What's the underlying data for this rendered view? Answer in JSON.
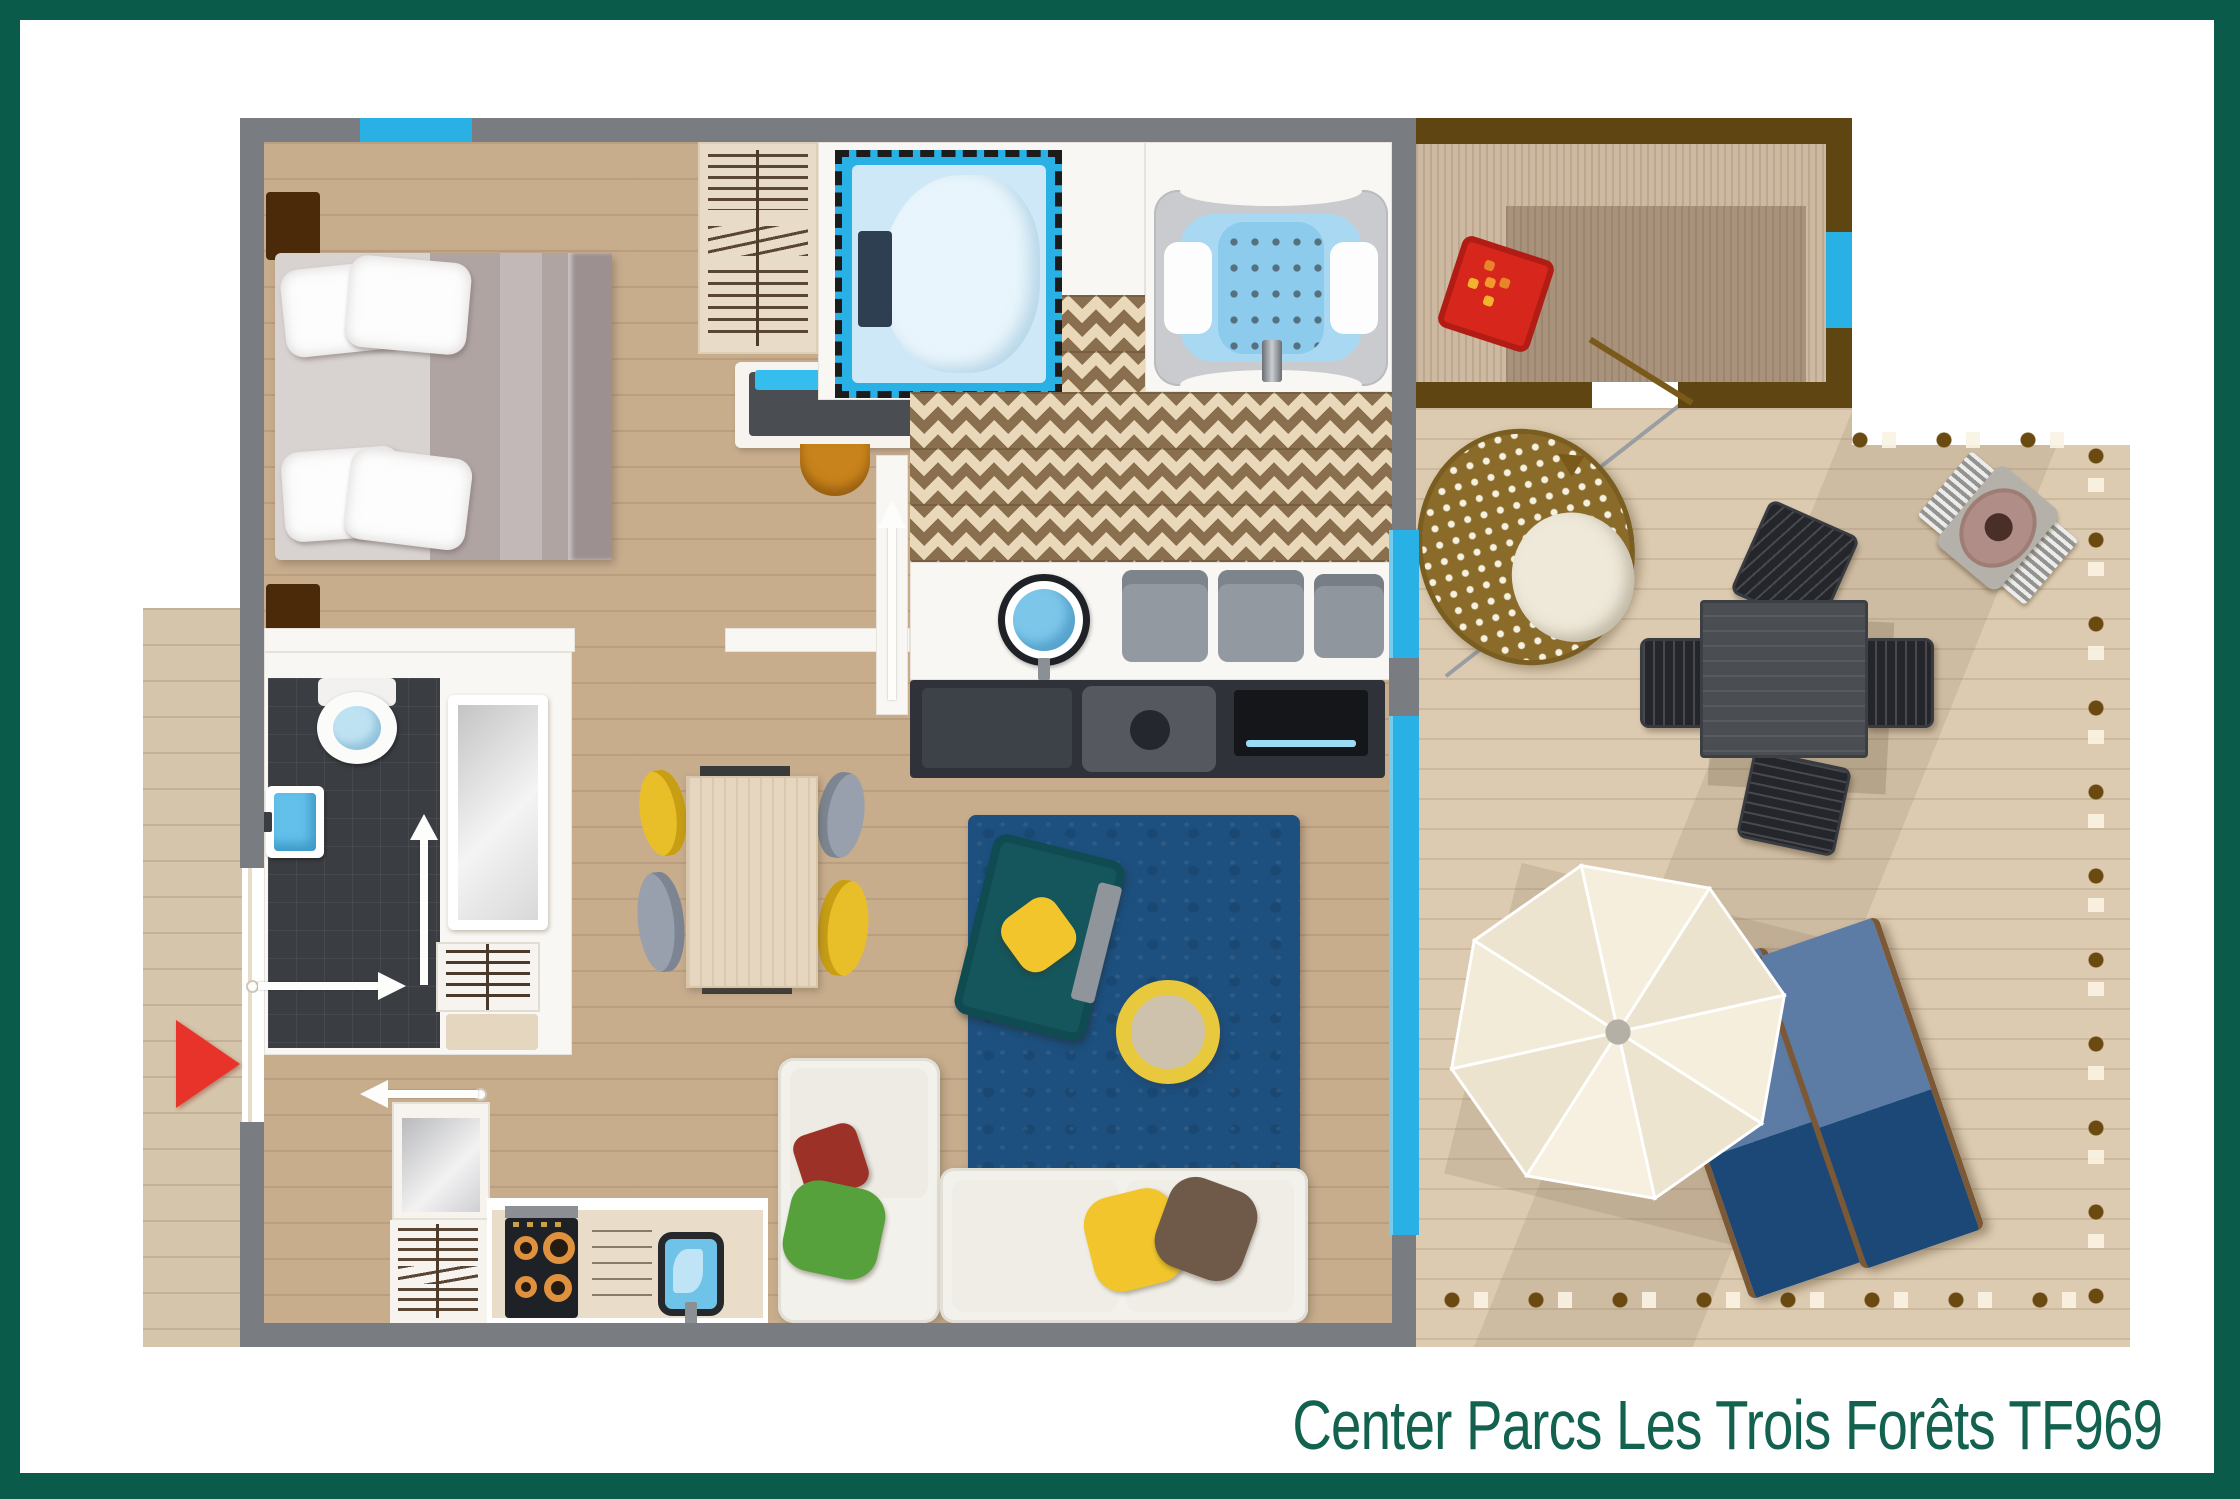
{
  "title": {
    "text": "Center Parcs Les Trois Forêts TF969",
    "color": "#13614f"
  },
  "palette": {
    "frame_green": "#0b5b4b",
    "wall_gray": "#797c81",
    "accent_cyan": "#29b1e6",
    "interior_wood": "#c8ad8d",
    "terrace_wood": "#dccbb0",
    "side_deck_wood": "#d5c5aa",
    "shed_brown": "#5e4512",
    "chevron_tile_brown": "#8a6f4e",
    "chevron_tile_cream": "#e9d8ba",
    "dark_tile": "#3a3d42",
    "rug_blue": "#1d507f",
    "sofa_ivory": "#f3f1ec",
    "accent_yellow": "#eec32d",
    "lounger_navy": "#1d4877",
    "lounger_steel": "#5d7ca5",
    "entrance_red": "#e8332a",
    "doormat_red": "#d7271d",
    "bed_mauve": "#b0a4a3",
    "tub_water_blue": "#a9d9f2"
  },
  "rooms": [
    {
      "name": "bedroom"
    },
    {
      "name": "kids-bedroom"
    },
    {
      "name": "bathroom"
    },
    {
      "name": "shower-room"
    },
    {
      "name": "hallway"
    },
    {
      "name": "kitchen"
    },
    {
      "name": "living-room"
    },
    {
      "name": "entrance-shed"
    },
    {
      "name": "terrace"
    },
    {
      "name": "side-deck"
    }
  ],
  "furniture": [
    {
      "name": "double-bed"
    },
    {
      "name": "nightstand"
    },
    {
      "name": "wardrobe"
    },
    {
      "name": "desk"
    },
    {
      "name": "desk-chair"
    },
    {
      "name": "single-bed"
    },
    {
      "name": "whirlpool-bathtub"
    },
    {
      "name": "vanity-sink"
    },
    {
      "name": "towel-stack"
    },
    {
      "name": "tv-unit"
    },
    {
      "name": "television"
    },
    {
      "name": "toilet"
    },
    {
      "name": "wall-sink"
    },
    {
      "name": "shower"
    },
    {
      "name": "radiator"
    },
    {
      "name": "fridge"
    },
    {
      "name": "drawer-unit"
    },
    {
      "name": "cooktop"
    },
    {
      "name": "dishwasher"
    },
    {
      "name": "kitchen-sink"
    },
    {
      "name": "dining-table"
    },
    {
      "name": "dining-chair-yellow"
    },
    {
      "name": "dining-chair-gray"
    },
    {
      "name": "rug"
    },
    {
      "name": "armchair"
    },
    {
      "name": "pouf"
    },
    {
      "name": "sofa"
    },
    {
      "name": "hanging-egg-chair"
    },
    {
      "name": "terrace-table"
    },
    {
      "name": "terrace-chair"
    },
    {
      "name": "barbecue"
    },
    {
      "name": "parasol"
    },
    {
      "name": "sun-lounger"
    },
    {
      "name": "doormat"
    },
    {
      "name": "entrance-arrow"
    }
  ]
}
